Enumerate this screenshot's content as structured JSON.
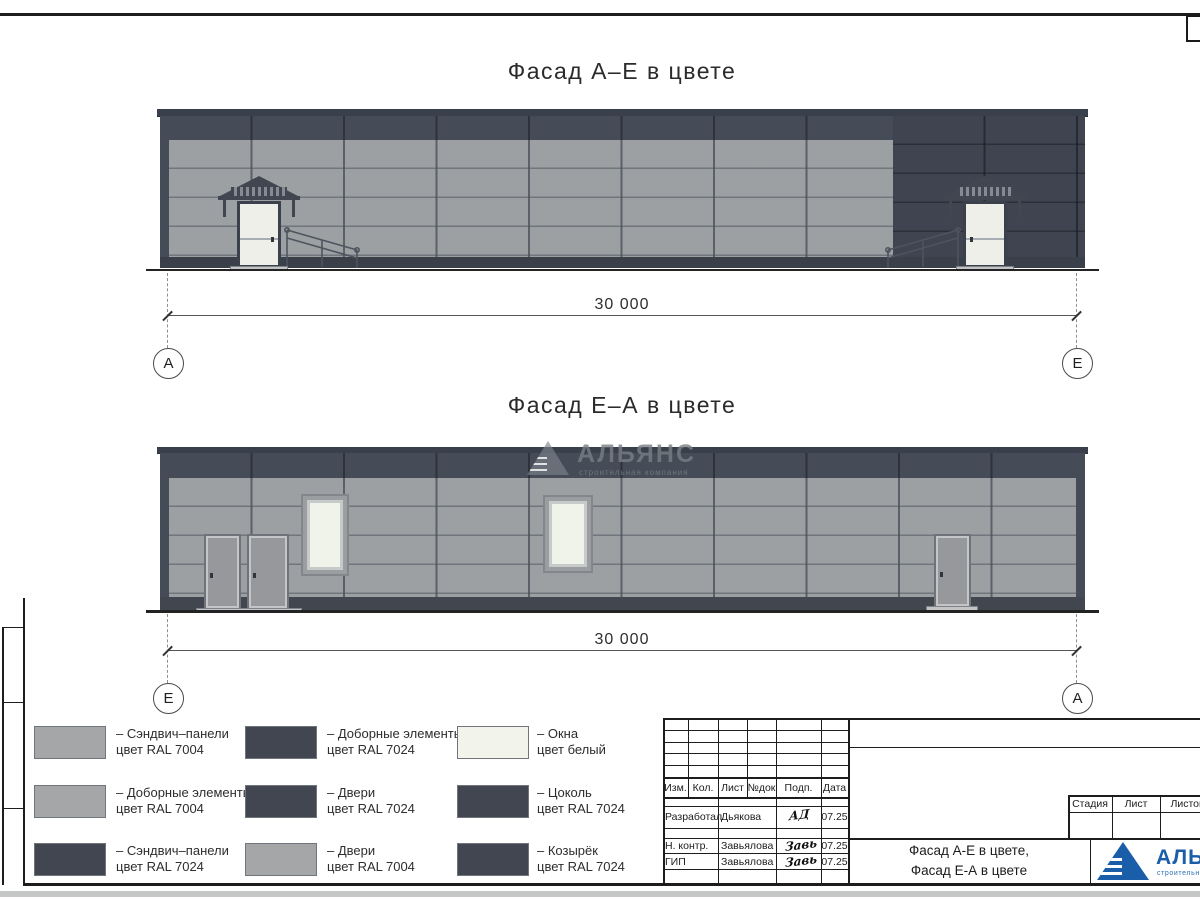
{
  "facade1": {
    "title": "Фасад А–Е в цвете",
    "dimension": "30 000",
    "axis_left": "А",
    "axis_right": "Е"
  },
  "facade2": {
    "title": "Фасад Е–А в цвете",
    "dimension": "30 000",
    "axis_left": "Е",
    "axis_right": "А"
  },
  "watermark": {
    "name": "АЛЬЯНС",
    "tagline": "строительная компания"
  },
  "legend": {
    "items": [
      {
        "line1": "– Сэндвич–панели",
        "line2": "цвет RAL 7004",
        "color": "#A4A6A8"
      },
      {
        "line1": "– Доборные элементы",
        "line2": "цвет RAL 7024",
        "color": "#414651"
      },
      {
        "line1": "– Окна",
        "line2": "цвет белый",
        "color": "#F2F4EC"
      },
      {
        "line1": "– Доборные элементы",
        "line2": "цвет RAL 7004",
        "color": "#A4A6A8"
      },
      {
        "line1": "– Двери",
        "line2": "цвет RAL 7024",
        "color": "#414651"
      },
      {
        "line1": "– Цоколь",
        "line2": "цвет RAL 7024",
        "color": "#414651"
      },
      {
        "line1": "– Сэндвич–панели",
        "line2": "цвет RAL 7024",
        "color": "#414651"
      },
      {
        "line1": "– Двери",
        "line2": "цвет RAL 7004",
        "color": "#A4A6A8"
      },
      {
        "line1": "– Козырёк",
        "line2": "цвет RAL 7024",
        "color": "#414651"
      }
    ]
  },
  "titleblock": {
    "headers": {
      "izm": "Изм.",
      "kol": "Кол.",
      "list": "Лист",
      "ndok": "№док",
      "podp": "Подп.",
      "data": "Дата"
    },
    "rows": [
      {
        "role": "Разработал",
        "name": "Дьякова",
        "sign": "АД",
        "date": "07.25"
      },
      {
        "role": "Н. контр.",
        "name": "Завьялова",
        "sign": "Завь",
        "date": "07.25"
      },
      {
        "role": "ГИП",
        "name": "Завьялова",
        "sign": "Завь",
        "date": "07.25"
      }
    ],
    "stage": {
      "stage": "Стадия",
      "sheet": "Лист",
      "sheets": "Листов"
    },
    "doc_title_line1": "Фасад А-Е в цвете,",
    "doc_title_line2": "Фасад Е-А в цвете",
    "logo": {
      "name": "АЛЬЯНС",
      "tagline": "строительная компания",
      "color": "#1A5DA8"
    }
  },
  "colors": {
    "ral7004": "#9DA0A3",
    "ral7024": "#414651",
    "window_white": "#F2F4EC"
  }
}
